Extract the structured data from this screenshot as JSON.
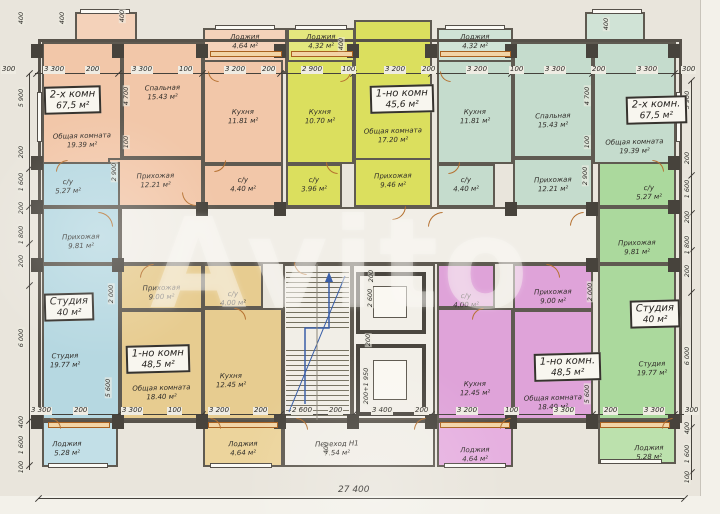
{
  "watermark": "Avito",
  "units": {
    "apt2k_left": {
      "type": "2-х комн",
      "area": "67,5 м²"
    },
    "apt1k_top": {
      "type": "1-но комн",
      "area": "45,6 м²"
    },
    "apt2k_right": {
      "type": "2-х комн.",
      "area": "67,5 м²"
    },
    "studio_left": {
      "type": "Студия",
      "area": "40 м²"
    },
    "apt1k_tan": {
      "type": "1-но комн",
      "area": "48,5 м²"
    },
    "apt1k_pink": {
      "type": "1-но комн.",
      "area": "48,5 м²"
    },
    "studio_right": {
      "type": "Студия",
      "area": "40 м²"
    }
  },
  "rooms": {
    "obsh_l": {
      "name": "Общая комната",
      "area": "19.39 м²"
    },
    "spal_l": {
      "name": "Спальная",
      "area": "15.43 м²"
    },
    "kuh_l": {
      "name": "Кухня",
      "area": "11.81 м²"
    },
    "lodzh_l": {
      "name": "Лоджия",
      "area": "4.64 м²"
    },
    "prih_l": {
      "name": "Прихожая",
      "area": "12.21 м²"
    },
    "su_l": {
      "name": "с/у",
      "area": "4.40 м²"
    },
    "kuh_y": {
      "name": "Кухня",
      "area": "10.70 м²"
    },
    "lodzh_y": {
      "name": "Лоджия",
      "area": "4.32 м²"
    },
    "obsh_y": {
      "name": "Общая комната",
      "area": "17.20 м²"
    },
    "prih_y": {
      "name": "Прихожая",
      "area": "9.46 м²"
    },
    "su_y": {
      "name": "с/у",
      "area": "3.96 м²"
    },
    "lodzh_m": {
      "name": "Лоджия",
      "area": "4.32 м²"
    },
    "kuh_m": {
      "name": "Кухня",
      "area": "11.81 м²"
    },
    "su_m": {
      "name": "с/у",
      "area": "4.40 м²"
    },
    "spal_m": {
      "name": "Спальная",
      "area": "15.43 м²"
    },
    "prih_m": {
      "name": "Прихожая",
      "area": "12.21 м²"
    },
    "obsh_m": {
      "name": "Общая комната",
      "area": "19.39 м²"
    },
    "su_b": {
      "name": "с/у",
      "area": "5.27 м²"
    },
    "prih_b": {
      "name": "Прихожая",
      "area": "9.81 м²"
    },
    "studio_b": {
      "name": "Студия",
      "area": "19.77 м²"
    },
    "lodzh_b": {
      "name": "Лоджия",
      "area": "5.28 м²"
    },
    "prih_t": {
      "name": "Прихожая",
      "area": "9.00 м²"
    },
    "su_t": {
      "name": "с/у",
      "area": "4.00 м²"
    },
    "obsh_t": {
      "name": "Общая комната",
      "area": "18.40 м²"
    },
    "kuh_t": {
      "name": "Кухня",
      "area": "12.45 м²"
    },
    "lodzh_t": {
      "name": "Лоджия",
      "area": "4.64 м²"
    },
    "su_p": {
      "name": "с/у",
      "area": "4.00 м²"
    },
    "prih_p": {
      "name": "Прихожая",
      "area": "9.00 м²"
    },
    "kuh_p": {
      "name": "Кухня",
      "area": "12.45 м²"
    },
    "obsh_p": {
      "name": "Общая комната",
      "area": "18.40 м²"
    },
    "lodzh_p": {
      "name": "Лоджия",
      "area": "4.64 м²"
    },
    "su_g": {
      "name": "с/у",
      "area": "5.27 м²"
    },
    "prih_g": {
      "name": "Прихожая",
      "area": "9.81 м²"
    },
    "studio_g": {
      "name": "Студия",
      "area": "19.77 м²"
    },
    "lodzh_g": {
      "name": "Лоджия",
      "area": "5.28 м²"
    },
    "perehod": {
      "name": "Переход Н1",
      "area": "7.54 м²"
    }
  },
  "dims": {
    "top": [
      "300",
      "3 300",
      "200",
      "3 300",
      "100",
      "3 200",
      "200",
      "2 900",
      "100",
      "3 200",
      "200",
      "3 200",
      "100",
      "3 300",
      "200",
      "3 300",
      "300"
    ],
    "bottom": [
      "3 300",
      "200",
      "3 300",
      "100",
      "3 200",
      "200",
      "2 600",
      "200",
      "3 400",
      "200",
      "3 200",
      "100",
      "3 300",
      "200",
      "3 300",
      "300"
    ],
    "left": [
      "400",
      "5 900",
      "200",
      "1 600",
      "200",
      "1 800",
      "200",
      "6 000",
      "400",
      "1 600",
      "100"
    ],
    "right": [
      "5 900",
      "200",
      "1 600",
      "200",
      "1 800",
      "200",
      "6 000",
      "400",
      "1 600",
      "100"
    ],
    "interior": [
      "400",
      "400",
      "4 700",
      "100",
      "2 900",
      "2 000",
      "5 600",
      "400",
      "400",
      "4 700",
      "100",
      "2 900",
      "2 000",
      "5 600",
      "200",
      "2 600",
      "200",
      "200+1 950",
      "400"
    ],
    "total": "27 400"
  },
  "colors": {
    "peach": "#f2c7a9",
    "yellow": "#dbdf5e",
    "mint": "#c5dccd",
    "blue": "#b6d8e1",
    "tan": "#e7cc90",
    "pink": "#dfa3d9",
    "green": "#abd99d",
    "wall": "#57524a",
    "stair_blue": "#3a5fa8",
    "door": "#b5702f"
  }
}
